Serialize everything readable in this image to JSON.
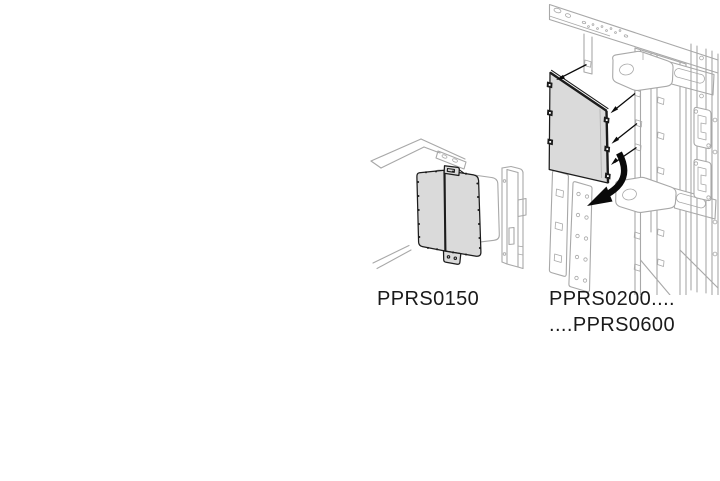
{
  "page": {
    "background": "#ffffff"
  },
  "colors": {
    "frame_line": "#a8a8a8",
    "panel_fill": "#dadada",
    "panel_outline": "#1c1c1c",
    "arrow": "#0a0a0a",
    "label_text": "#1a1a1a"
  },
  "figures": {
    "left": {
      "label": "PPRS0150",
      "description": "blind side panel mounted on switchgear corner frame"
    },
    "right": {
      "label_line1": "PPRS0200....",
      "label_line2": "....PPRS0600",
      "description": "side panel with mounting screws, arrows and perforated fixing strips on switchgear frame"
    }
  }
}
